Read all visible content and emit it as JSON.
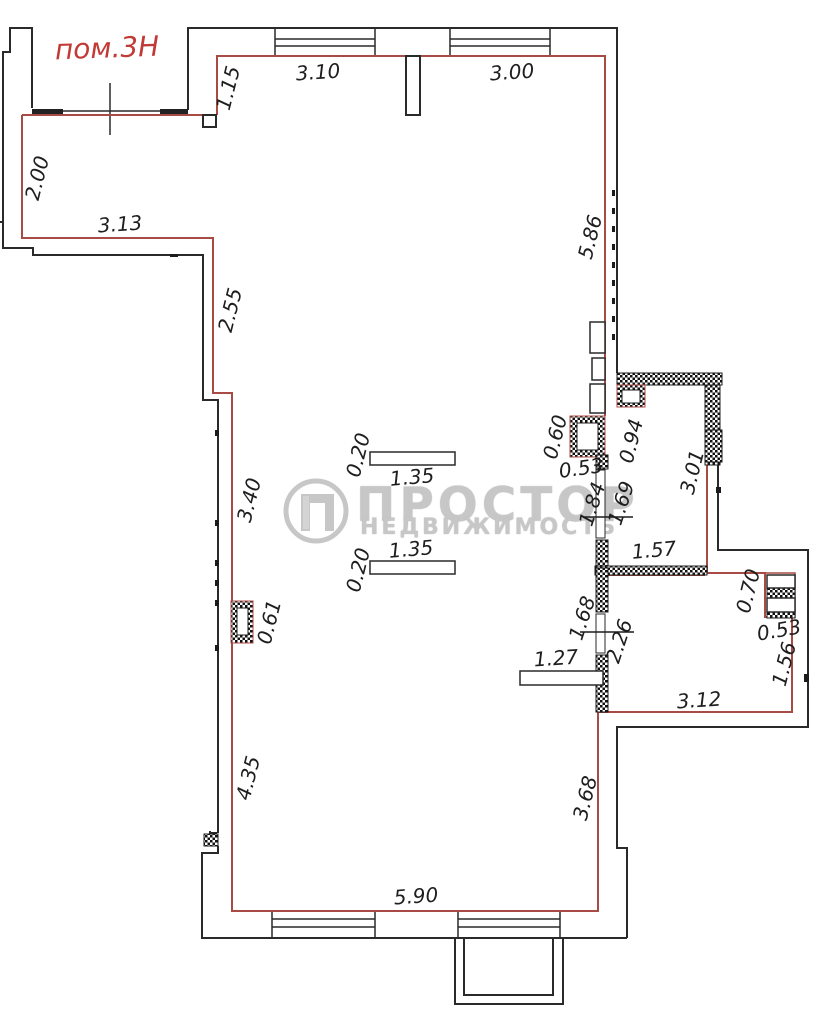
{
  "room_label": "пом.3Н",
  "watermark": {
    "brand": "ПРОСТОР",
    "sub": "НЕДВИЖИМОСТЬ"
  },
  "colors": {
    "boundary_red": "#a84b44",
    "room_label_red": "#c13a35",
    "wall_black": "#2a2a2a",
    "watermark_gray": "#c7c7c7"
  },
  "units": "m",
  "dimensions": [
    {
      "t": "1.15",
      "x": 228,
      "y": 88,
      "r": -76
    },
    {
      "t": "3.10",
      "x": 318,
      "y": 72,
      "r": -4
    },
    {
      "t": "3.00",
      "x": 512,
      "y": 72,
      "r": -4
    },
    {
      "t": "2.00",
      "x": 37,
      "y": 178,
      "r": -76
    },
    {
      "t": "3.13",
      "x": 120,
      "y": 224,
      "r": -4
    },
    {
      "t": "5.86",
      "x": 590,
      "y": 237,
      "r": -76
    },
    {
      "t": "2.55",
      "x": 230,
      "y": 310,
      "r": -76
    },
    {
      "t": "3.40",
      "x": 249,
      "y": 500,
      "r": -76
    },
    {
      "t": "0.20",
      "x": 358,
      "y": 455,
      "r": -76
    },
    {
      "t": "1.35",
      "x": 412,
      "y": 477,
      "r": -5
    },
    {
      "t": "1.35",
      "x": 411,
      "y": 549,
      "r": -5
    },
    {
      "t": "0.20",
      "x": 358,
      "y": 570,
      "r": -76
    },
    {
      "t": "0.61",
      "x": 269,
      "y": 622,
      "r": -76
    },
    {
      "t": "0.60",
      "x": 555,
      "y": 437,
      "r": -76
    },
    {
      "t": "0.53",
      "x": 581,
      "y": 468,
      "r": -8
    },
    {
      "t": "0.94",
      "x": 631,
      "y": 441,
      "r": -76
    },
    {
      "t": "3.01",
      "x": 692,
      "y": 472,
      "r": -76
    },
    {
      "t": "1.84",
      "x": 592,
      "y": 504,
      "r": -72
    },
    {
      "t": "1.69",
      "x": 621,
      "y": 503,
      "r": -72
    },
    {
      "t": "1.57",
      "x": 654,
      "y": 550,
      "r": -5
    },
    {
      "t": "1.68",
      "x": 582,
      "y": 618,
      "r": -72
    },
    {
      "t": "2.26",
      "x": 619,
      "y": 641,
      "r": -72
    },
    {
      "t": "1.27",
      "x": 556,
      "y": 658,
      "r": -4
    },
    {
      "t": "0.70",
      "x": 748,
      "y": 591,
      "r": -76
    },
    {
      "t": "0.53",
      "x": 779,
      "y": 630,
      "r": -10
    },
    {
      "t": "1.56",
      "x": 784,
      "y": 664,
      "r": -76
    },
    {
      "t": "3.12",
      "x": 699,
      "y": 700,
      "r": -4
    },
    {
      "t": "4.35",
      "x": 248,
      "y": 778,
      "r": -76
    },
    {
      "t": "3.68",
      "x": 585,
      "y": 798,
      "r": -76
    },
    {
      "t": "5.90",
      "x": 416,
      "y": 896,
      "r": -4
    }
  ]
}
